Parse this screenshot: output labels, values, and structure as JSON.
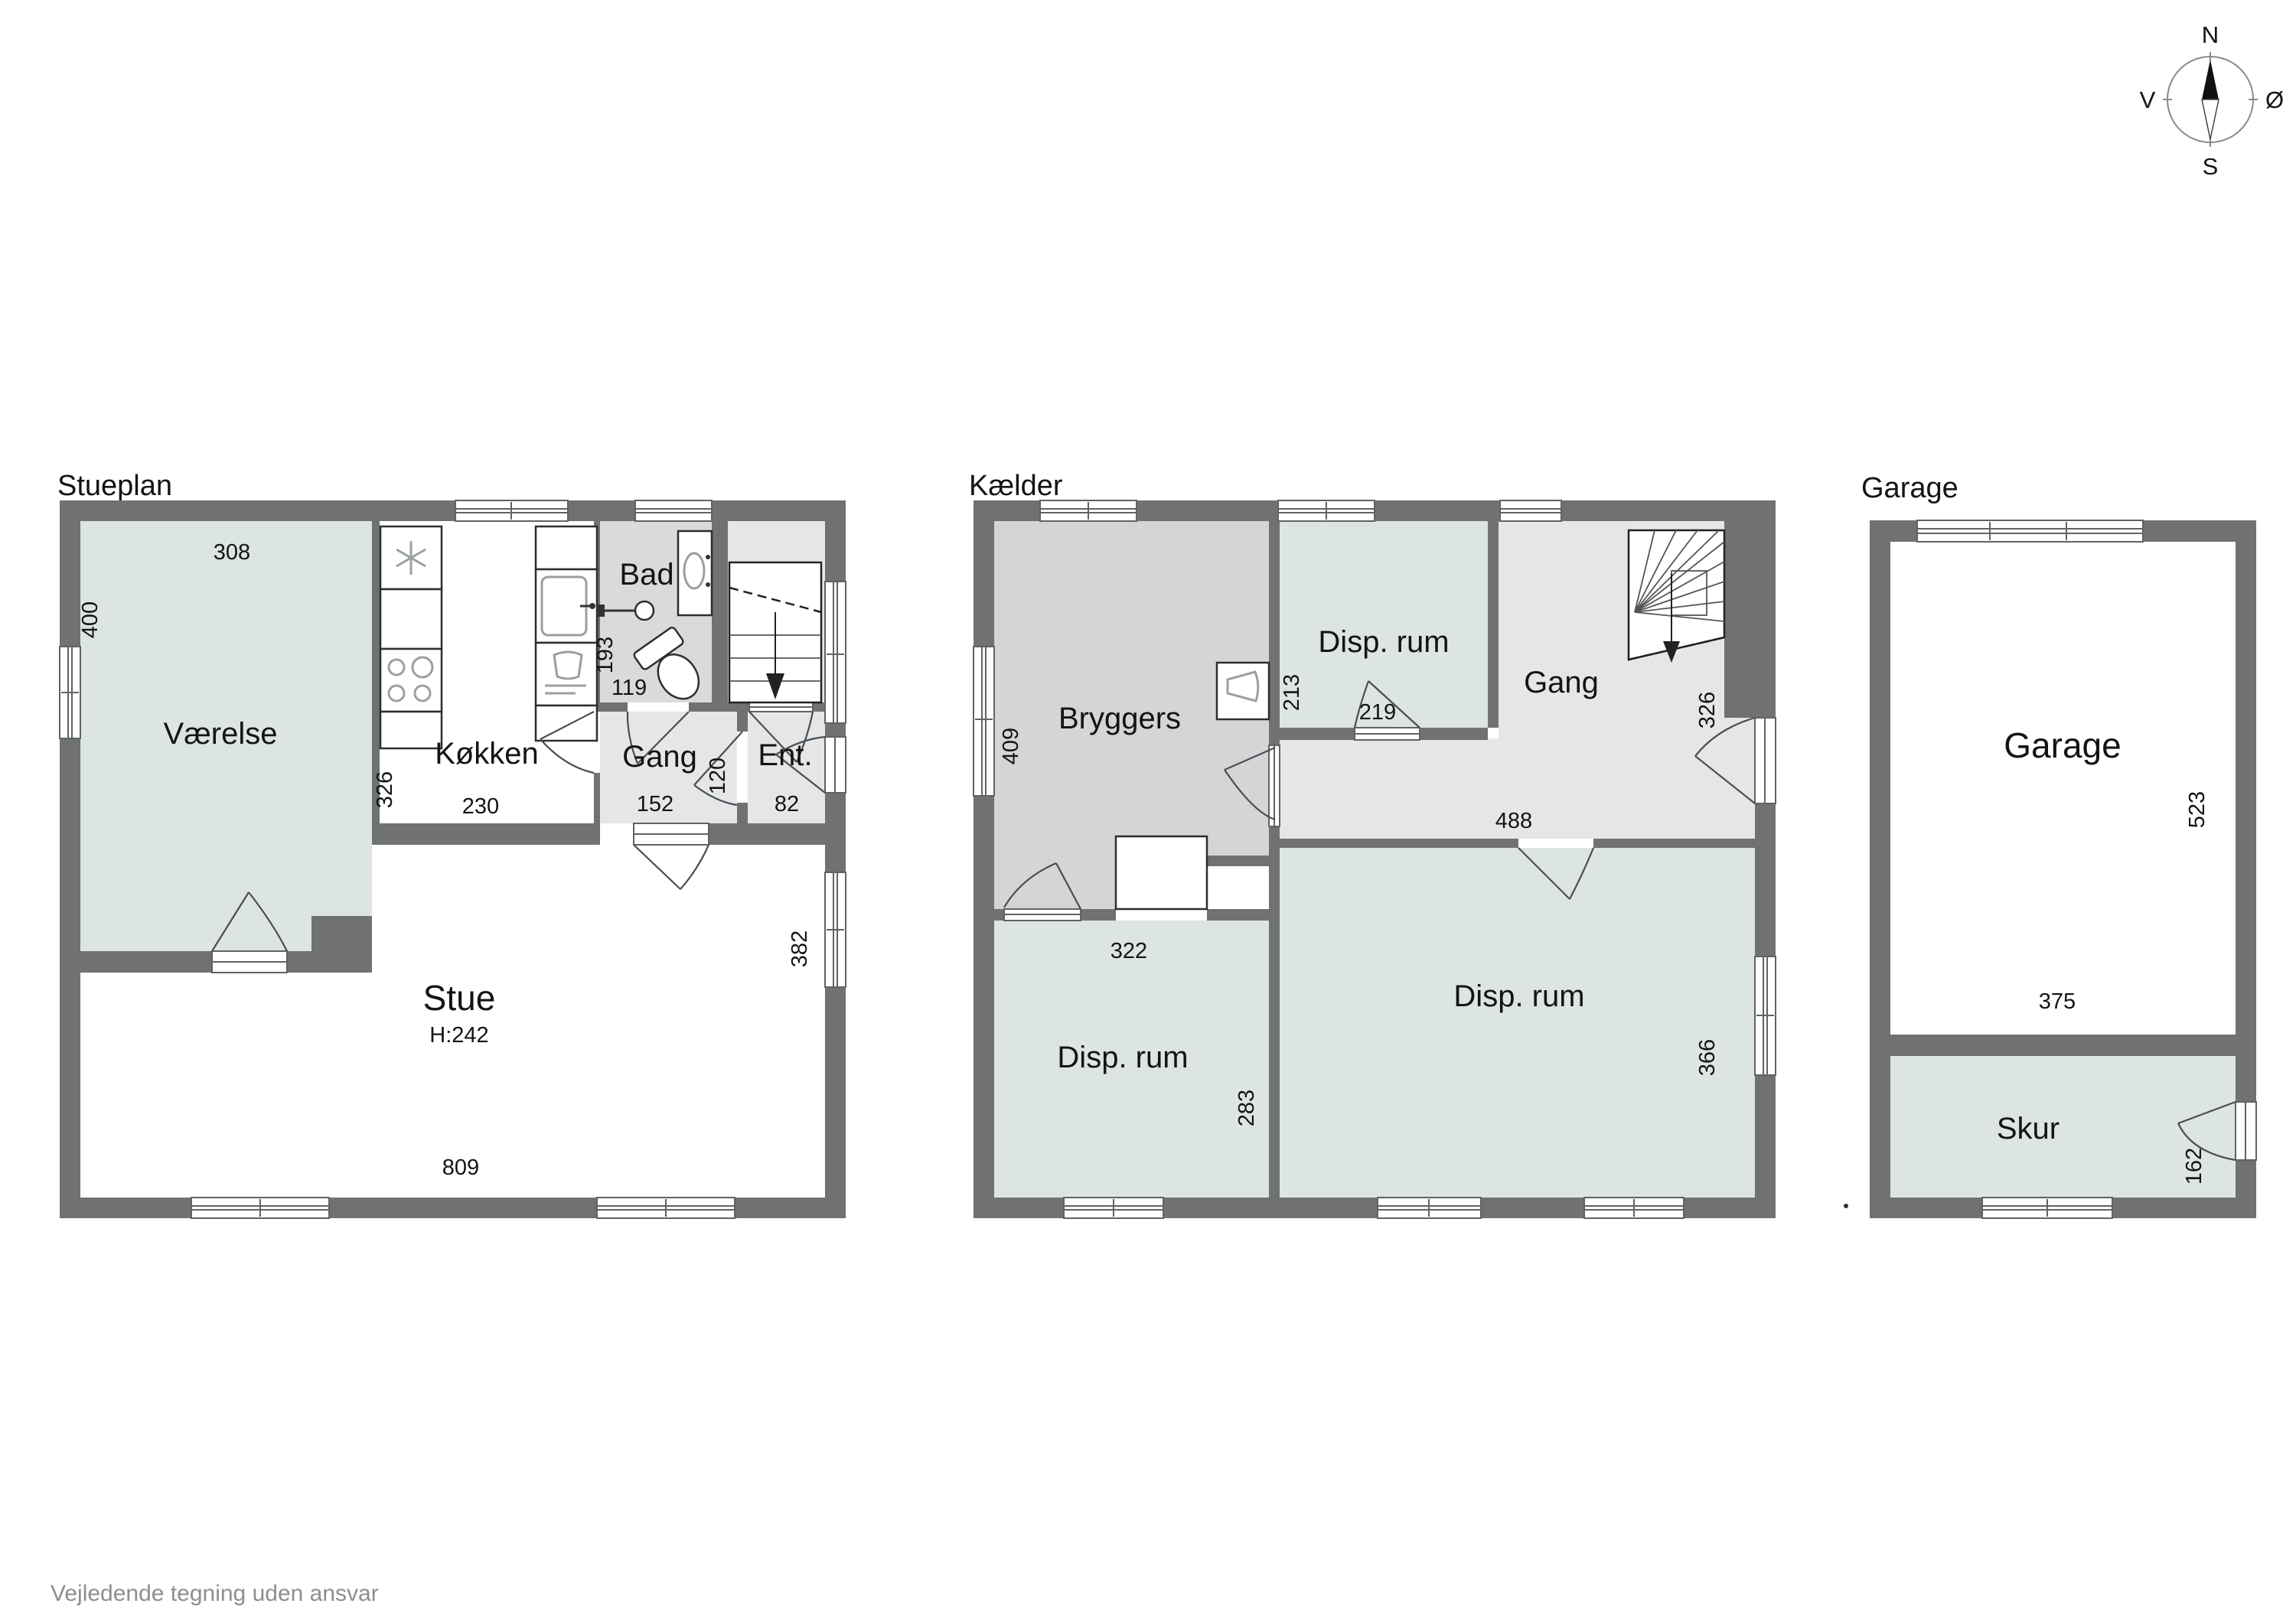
{
  "page": {
    "disclaimer": "Vejledende tegning uden ansvar"
  },
  "colors": {
    "background": "#ffffff",
    "wall": "#6f7173",
    "room_green": "#dce5df",
    "room_gray": "#d3d5d7",
    "room_light": "#e4e6e8",
    "room_bad": "#d8dadc",
    "text": "#141414",
    "muted_text": "#8e8e8e"
  },
  "compass": {
    "north": "N",
    "south": "S",
    "west": "V",
    "east": "Ø"
  },
  "stueplan": {
    "title": "Stueplan",
    "rooms": {
      "vaerelse": "Værelse",
      "koekken": "Køkken",
      "bad": "Bad",
      "gang": "Gang",
      "ent": "Ent.",
      "stue": "Stue"
    },
    "dims": {
      "w308": "308",
      "h400": "400",
      "h326": "326",
      "w230": "230",
      "h193": "193",
      "w119": "119",
      "h120": "120",
      "w152": "152",
      "w82": "82",
      "w809": "809",
      "h382": "382",
      "ceiling": "H:242"
    }
  },
  "kaelder": {
    "title": "Kælder",
    "rooms": {
      "bryggers": "Bryggers",
      "disp_top": "Disp. rum",
      "gang": "Gang",
      "disp_left": "Disp. rum",
      "disp_right": "Disp. rum"
    },
    "dims": {
      "h409": "409",
      "h213": "213",
      "w219": "219",
      "h326": "326",
      "w488": "488",
      "w322": "322",
      "h283": "283",
      "h366": "366"
    }
  },
  "garage": {
    "title": "Garage",
    "rooms": {
      "garage": "Garage",
      "skur": "Skur"
    },
    "dims": {
      "h523": "523",
      "w375": "375",
      "h162": "162"
    }
  }
}
